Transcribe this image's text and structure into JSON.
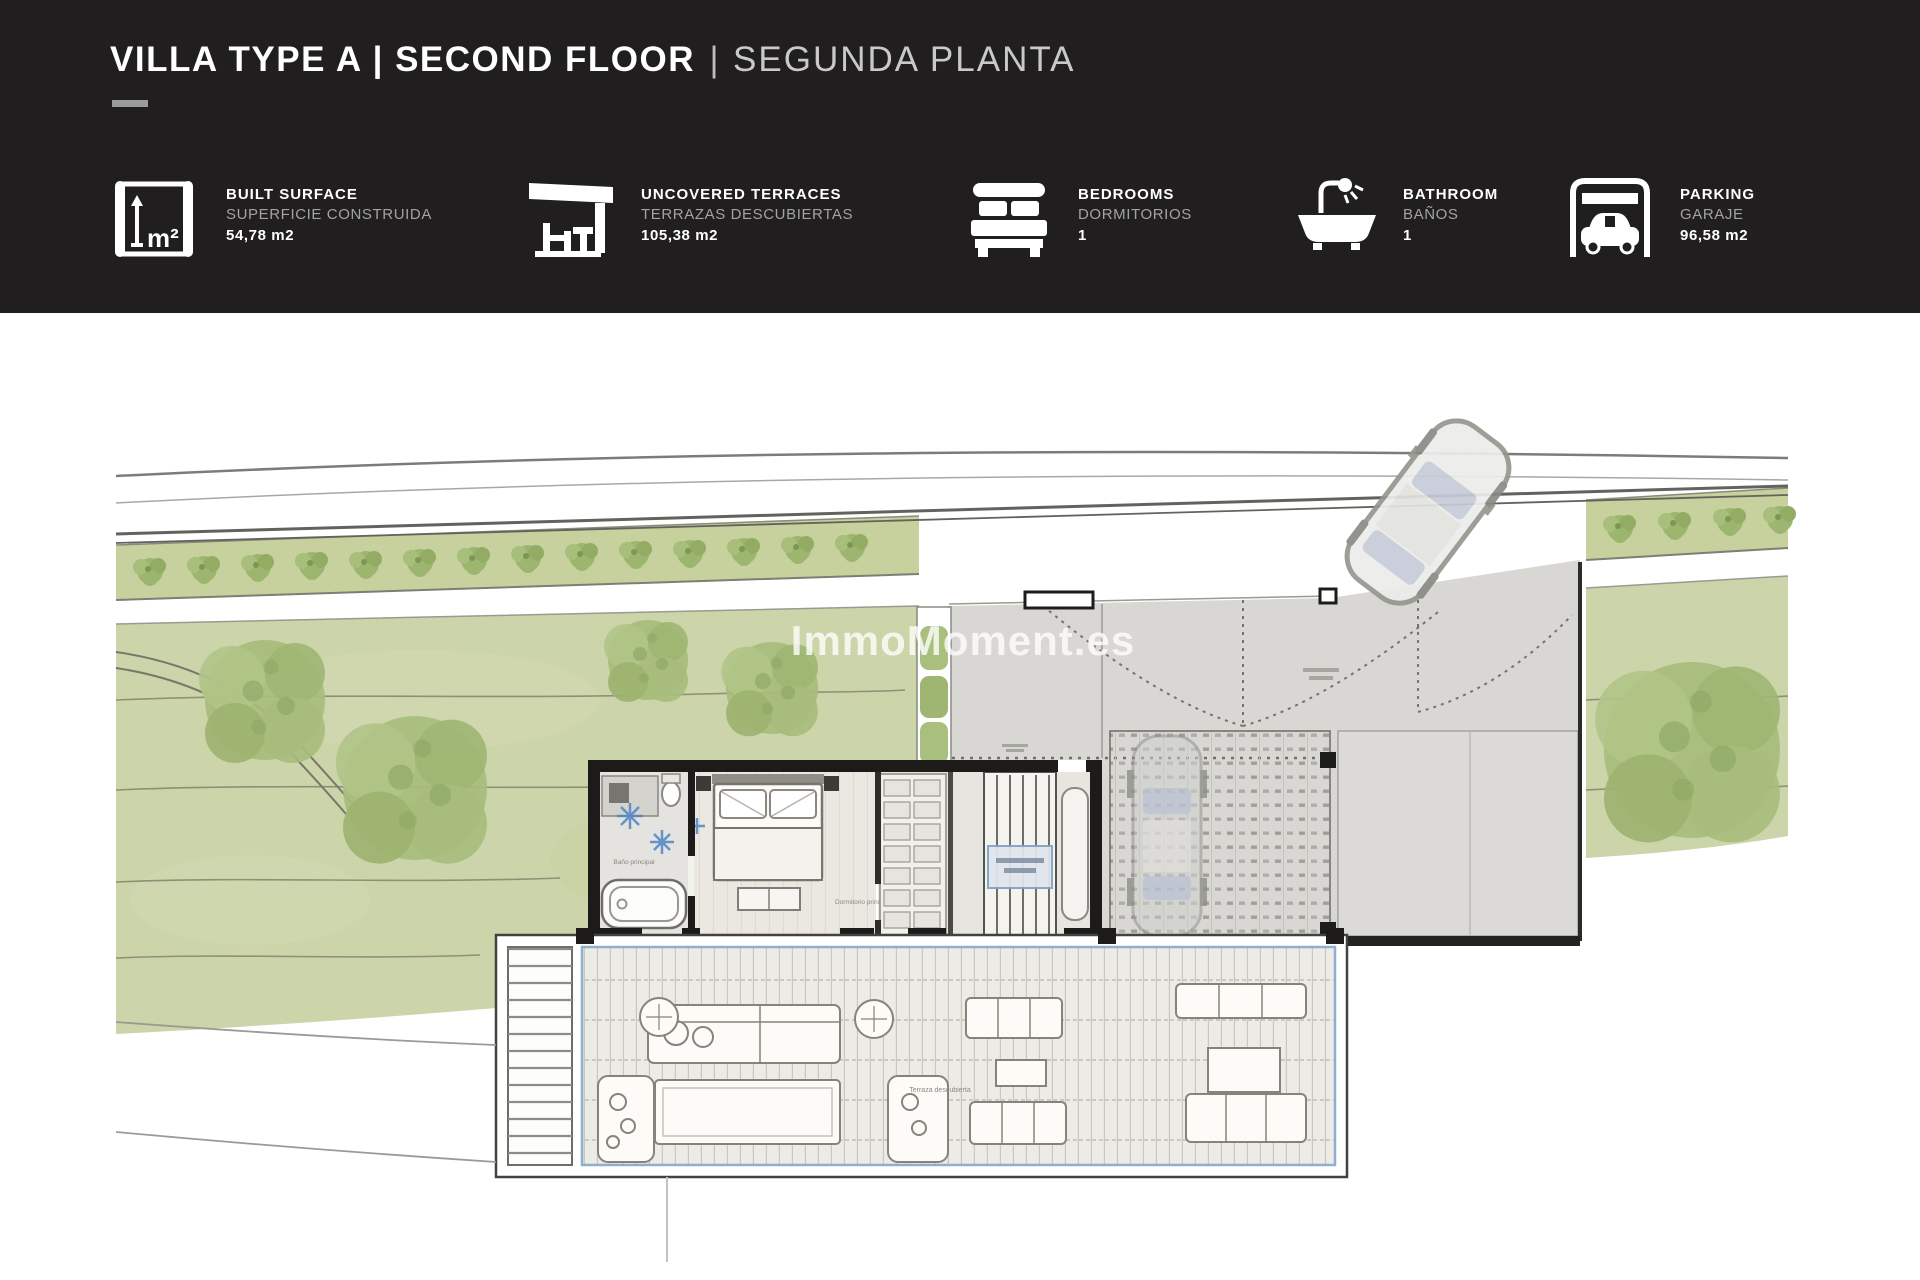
{
  "header": {
    "title_main": "VILLA TYPE A | SECOND FLOOR",
    "title_sep": "|",
    "title_sub": "SEGUNDA PLANTA",
    "bg_color": "#201e1e"
  },
  "stats": [
    {
      "icon": "built-surface-icon",
      "label_en": "BUILT SURFACE",
      "label_es": "SUPERFICIE CONSTRUIDA",
      "value": "54,78 m2"
    },
    {
      "icon": "uncovered-terraces-icon",
      "label_en": "UNCOVERED TERRACES",
      "label_es": "TERRAZAS DESCUBIERTAS",
      "value": "105,38 m2"
    },
    {
      "icon": "bedrooms-icon",
      "label_en": "BEDROOMS",
      "label_es": "DORMITORIOS",
      "value": "1"
    },
    {
      "icon": "bathroom-icon",
      "label_en": "BATHROOM",
      "label_es": "BAÑOS",
      "value": "1"
    },
    {
      "icon": "parking-icon",
      "label_en": "PARKING",
      "label_es": "GARAJE",
      "value": "96,58 m2"
    }
  ],
  "watermark": "ImmoMoment.es",
  "plan": {
    "labels": {
      "bedroom": "Dormitorio principal",
      "bathroom": "Baño principal",
      "terrace": "Terraza descubierta"
    }
  },
  "colors": {
    "header_bg": "#201e1e",
    "lawn_green": "#ccd5a9",
    "hedge_green": "#c6d19e",
    "tree_green": "#a7bd7c",
    "driveway_gray": "#d8d7d3",
    "deck_gray": "#edebe5",
    "wall_black": "#1c1b19",
    "accent_blue": "#7fa3c6"
  }
}
